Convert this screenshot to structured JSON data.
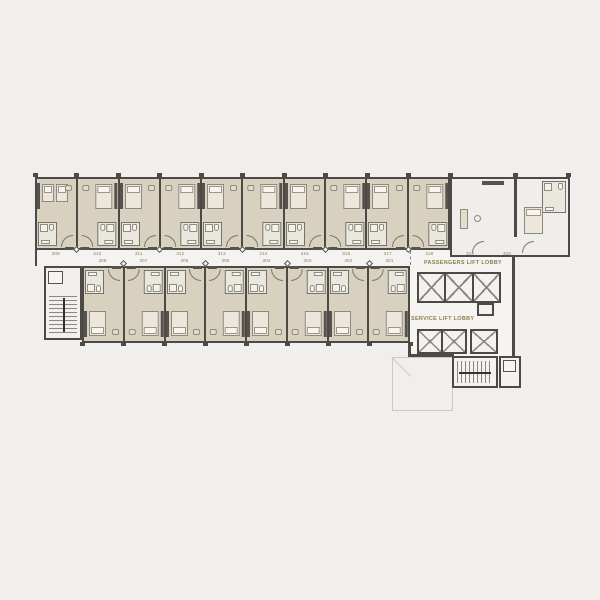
{
  "plan": {
    "title": "hotel-guestroom-floor-plan",
    "labels": {
      "passengers_lobby": "PASSENGERS LIFT LOBBY",
      "service_lobby": "SERVICE LIFT LOBBY"
    },
    "rooms_top": [
      {
        "number": "309",
        "type": "twin"
      },
      {
        "number": "310",
        "type": "king"
      },
      {
        "number": "311",
        "type": "king"
      },
      {
        "number": "312",
        "type": "king"
      },
      {
        "number": "313",
        "type": "king"
      },
      {
        "number": "314",
        "type": "king"
      },
      {
        "number": "315",
        "type": "king"
      },
      {
        "number": "316",
        "type": "king"
      },
      {
        "number": "317",
        "type": "king"
      },
      {
        "number": "318",
        "type": "king"
      }
    ],
    "rooms_suite": [
      {
        "number": "319"
      },
      {
        "number": "320"
      }
    ],
    "rooms_bottom": [
      {
        "number": "308",
        "type": "king"
      },
      {
        "number": "307",
        "type": "king"
      },
      {
        "number": "306",
        "type": "king"
      },
      {
        "number": "305",
        "type": "king"
      },
      {
        "number": "304",
        "type": "king"
      },
      {
        "number": "303",
        "type": "king"
      },
      {
        "number": "302",
        "type": "king"
      },
      {
        "number": "301",
        "type": "king"
      }
    ],
    "core": {
      "passenger_lift_count": 3,
      "service_lift_count": 2,
      "stair_count": 2
    },
    "colors": {
      "background": "#f0efee",
      "wall": "#4c4a47",
      "room_fill": "#d8d1c0",
      "bath_fill": "#eae7de",
      "corridor_fill": "#f4f3f1",
      "label_text": "#8f7c50",
      "shaft_mark": "#8b8780",
      "roof_outline": "#cbc9c5"
    }
  }
}
